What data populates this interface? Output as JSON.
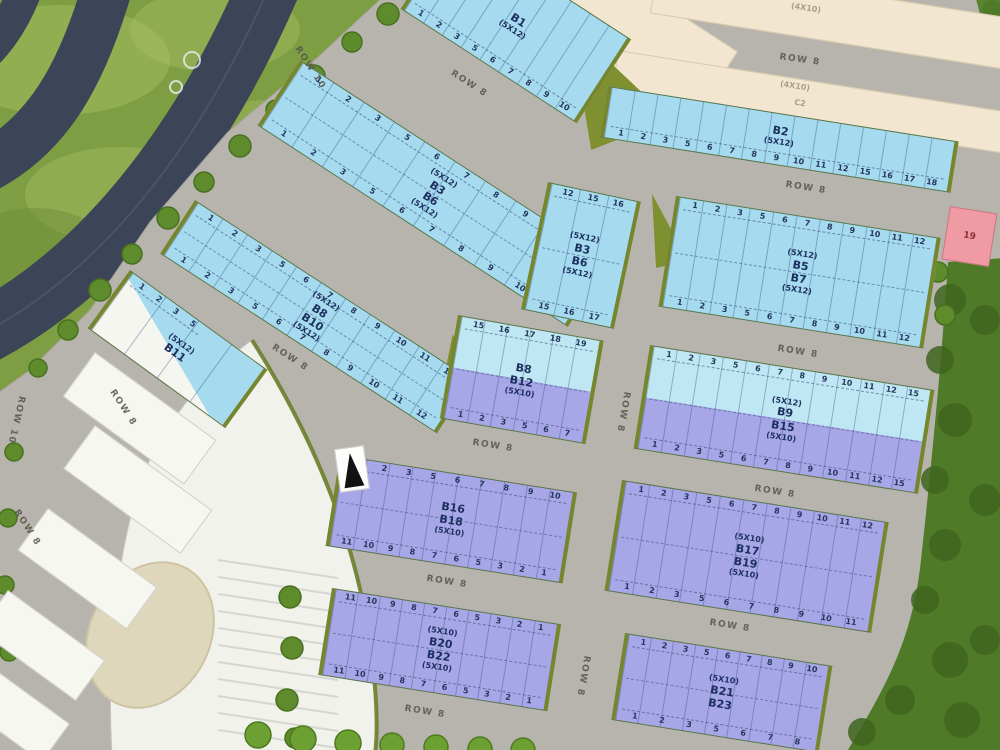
{
  "scene": {
    "type": "residential-plot-site-plan"
  },
  "labels": {
    "row8": "ROW 8",
    "row10": "ROW 10",
    "size_4x10": "(4X10)",
    "c2": "C2"
  },
  "colors": {
    "grass": "#7E9E43",
    "forest": "#4F7A28",
    "road": "#B7B4AD",
    "highway": "#3C4557",
    "plot_blue": "#A5DAEF",
    "plot_cyan_light": "#BFE7F3",
    "plot_purple": "#A7A7E7",
    "plot_cream": "#F2E6D0",
    "plot_pink": "#F09AA4",
    "building_white": "#F2F2EC",
    "hedge_olive": "#76862D"
  },
  "blocks": {
    "b1": {
      "l1": "B1",
      "l2": "(5X12)",
      "bottom": [
        "1",
        "2",
        "3",
        "5",
        "6",
        "7",
        "8",
        "9",
        "10"
      ]
    },
    "b2": {
      "l1": "B2",
      "l2": "(5X12)",
      "bottom": [
        "1",
        "2",
        "3",
        "5",
        "6",
        "7",
        "8",
        "9",
        "10",
        "11",
        "12",
        "15",
        "16",
        "17",
        "18"
      ]
    },
    "b3b6_strip": {
      "l1": "(5X12)",
      "l2": "B3",
      "l3": "B6",
      "l4": "(5X12)",
      "top": [
        "1",
        "2",
        "3",
        "5",
        "6",
        "7",
        "8",
        "9",
        "10",
        "11"
      ],
      "bottom": [
        "1",
        "2",
        "3",
        "5",
        "6",
        "7",
        "8",
        "9",
        "10",
        "11"
      ]
    },
    "b3b6_end": {
      "l1": "(5X12)",
      "l2": "B3",
      "l3": "B6",
      "l4": "(5X12)",
      "top": [
        "12",
        "15",
        "16"
      ],
      "bottom": [
        "15",
        "16",
        "17"
      ]
    },
    "b5b7": {
      "l1": "(5X12)",
      "l2": "B5",
      "l3": "B7",
      "l4": "(5X12)",
      "top": [
        "1",
        "2",
        "3",
        "5",
        "6",
        "7",
        "8",
        "9",
        "10",
        "11",
        "12"
      ],
      "bottom": [
        "1",
        "2",
        "3",
        "5",
        "6",
        "7",
        "8",
        "9",
        "10",
        "11",
        "12"
      ]
    },
    "b8b10": {
      "l1": "(5X12)",
      "l2": "B8",
      "l3": "B10",
      "l4": "(5X12)",
      "top": [
        "1",
        "2",
        "3",
        "5",
        "6",
        "7",
        "8",
        "9",
        "10",
        "11",
        "12"
      ],
      "bottom": [
        "1",
        "2",
        "3",
        "5",
        "6",
        "7",
        "8",
        "9",
        "10",
        "11",
        "12"
      ]
    },
    "b11": {
      "l1": "(5X12)",
      "l2": "B11",
      "top": [
        "1",
        "2",
        "3",
        "5"
      ]
    },
    "b8b12": {
      "l1": "B8",
      "l2": "B12",
      "l3": "(5X10)",
      "top": [
        "15",
        "16",
        "17",
        "18",
        "19"
      ],
      "bottom": [
        "1",
        "2",
        "3",
        "5",
        "6",
        "7"
      ]
    },
    "b9b15": {
      "l1": "(5X12)",
      "l2": "B9",
      "l3": "B15",
      "l4": "(5X10)",
      "top": [
        "1",
        "2",
        "3",
        "5",
        "6",
        "7",
        "8",
        "9",
        "10",
        "11",
        "12",
        "15"
      ],
      "bottom": [
        "1",
        "2",
        "3",
        "5",
        "6",
        "7",
        "8",
        "9",
        "10",
        "11",
        "12",
        "15"
      ]
    },
    "b16b18": {
      "l1": "B16",
      "l2": "B18",
      "l3": "(5X10)",
      "top": [
        "1",
        "2",
        "3",
        "5",
        "6",
        "7",
        "8",
        "9",
        "10"
      ],
      "bottom": [
        "11",
        "10",
        "9",
        "8",
        "7",
        "6",
        "5",
        "3",
        "2",
        "1"
      ]
    },
    "b17b19": {
      "l1": "(5X10)",
      "l2": "B17",
      "l3": "B19",
      "l4": "(5X10)",
      "top": [
        "1",
        "2",
        "3",
        "5",
        "6",
        "7",
        "8",
        "9",
        "10",
        "11",
        "12"
      ],
      "bottom": [
        "1",
        "2",
        "3",
        "5",
        "6",
        "7",
        "8",
        "9",
        "10",
        "11"
      ]
    },
    "b20b22": {
      "l1": "(5X10)",
      "l2": "B20",
      "l3": "B22",
      "l4": "(5X10)",
      "top": [
        "11",
        "10",
        "9",
        "8",
        "7",
        "6",
        "5",
        "3",
        "2",
        "1"
      ],
      "bottom": [
        "11",
        "10",
        "9",
        "8",
        "7",
        "6",
        "5",
        "3",
        "2",
        "1"
      ]
    },
    "b21b23": {
      "l1": "(5X10)",
      "l2": "B21",
      "l3": "B23",
      "top": [
        "1",
        "2",
        "3",
        "5",
        "6",
        "7",
        "8",
        "9",
        "10"
      ],
      "bottom": [
        "1",
        "2",
        "3",
        "5",
        "6",
        "7",
        "8"
      ]
    },
    "lot19": {
      "l1": "19"
    }
  }
}
